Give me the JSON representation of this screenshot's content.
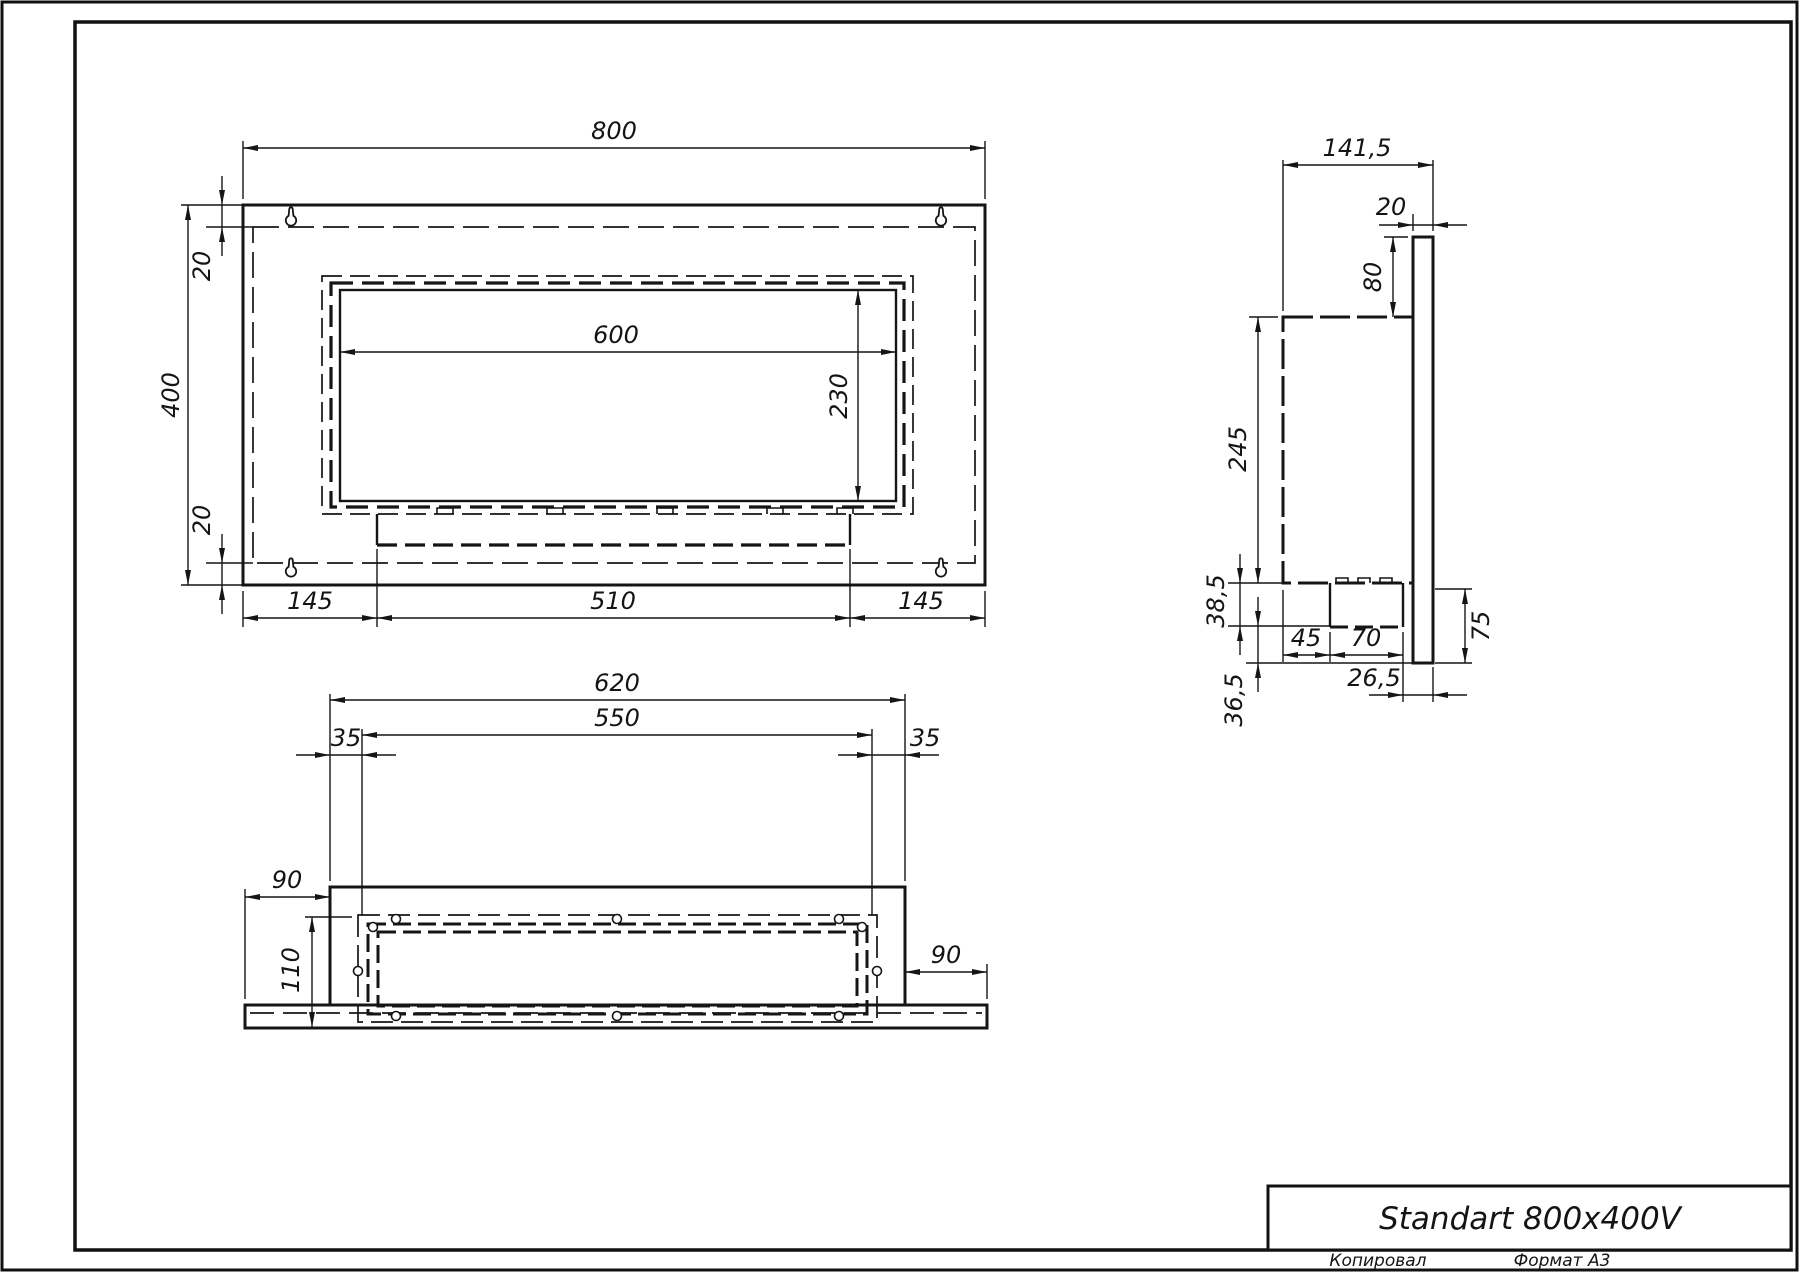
{
  "title_block": {
    "title": "Standart 800x400V",
    "copied_label": "Копировал",
    "format_label": "Формат А3"
  },
  "colors": {
    "line": "#151515",
    "background": "#ffffff"
  },
  "views": {
    "front_view": {
      "name": "Front view",
      "dims": {
        "overall_width": "800",
        "overall_height": "400",
        "top_inset": "20",
        "bottom_inset": "20",
        "opening_width": "600",
        "opening_height": "230",
        "left_margin": "145",
        "burner_width": "510",
        "right_margin": "145"
      }
    },
    "side_view": {
      "name": "Side view",
      "dims": {
        "overall_depth": "141,5",
        "plate_thickness": "20",
        "top_offset": "80",
        "body_height": "245",
        "tray_depth": "38,5",
        "lower_offset": "36,5",
        "front_gap": "45",
        "tray_width": "70",
        "bottom_flange": "75",
        "rear_gap": "26,5"
      }
    },
    "bottom_view": {
      "name": "Bottom view",
      "dims": {
        "body_width": "620",
        "inner_width": "550",
        "left_inset": "35",
        "right_inset": "35",
        "left_flange": "90",
        "right_flange": "90",
        "body_depth": "110"
      }
    }
  }
}
